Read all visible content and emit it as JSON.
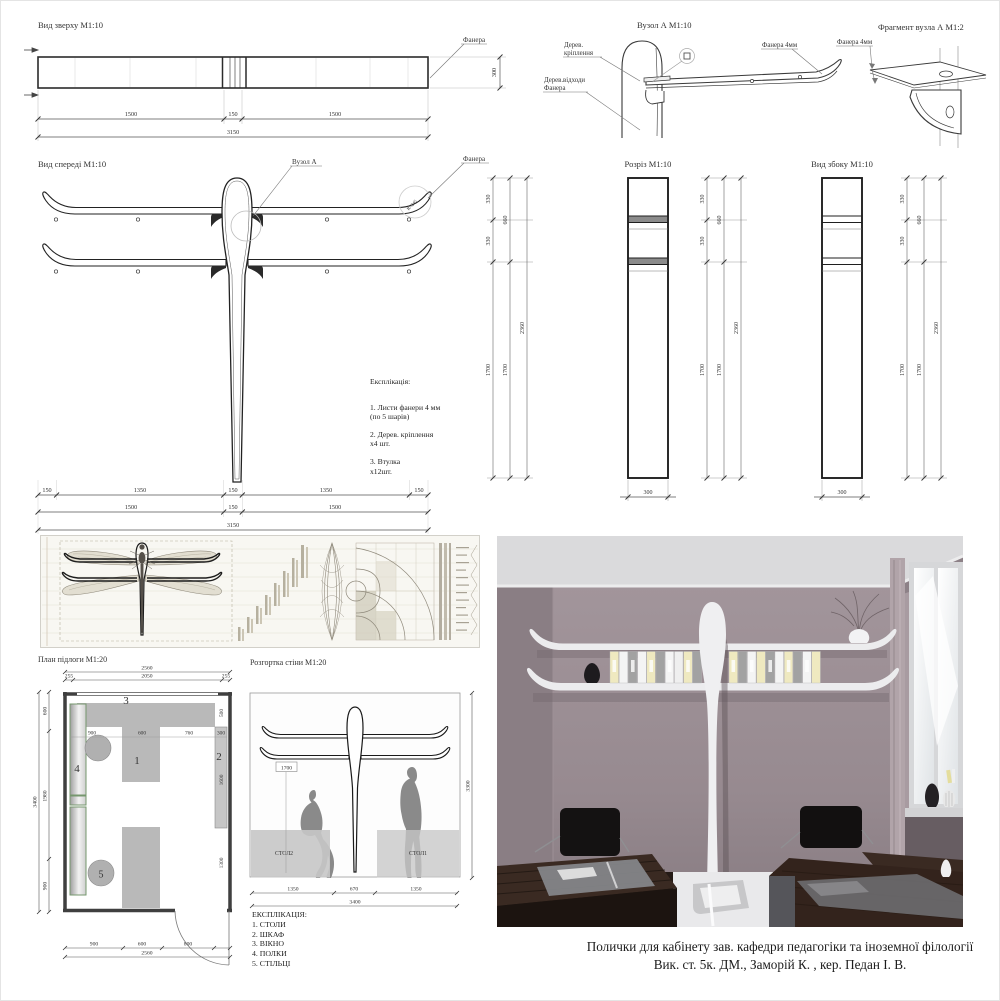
{
  "top_view": {
    "title": "Вид зверху М1:10",
    "plywood_label": "Фанера",
    "row1": [
      "1500",
      "150",
      "1500"
    ],
    "total": "3150",
    "depth": "300"
  },
  "node_a": {
    "title": "Вузол А М1:10",
    "wood_mount_l1": "Дерев.",
    "wood_mount_l2": "кріплення",
    "wood_waste_l1": "Дерев.відходи",
    "wood_waste_l2": "Фанера",
    "plywood_label": "Фанера 4мм"
  },
  "fragment_a": {
    "title": "Фрагмент вузла А М1:2",
    "plywood_label": "Фанера 4мм"
  },
  "front_view": {
    "title": "Вид спереді М1:10",
    "node_label": "Вузол А",
    "plywood_label": "Фанера",
    "radius": "R=245",
    "row1": [
      "150",
      "1350",
      "150",
      "1350",
      "150"
    ],
    "row2": [
      "1500",
      "150",
      "1500"
    ],
    "total": "3150"
  },
  "parts_list": {
    "title": "Експлікація:",
    "items": [
      {
        "l1": "1. Листи фанери 4 мм",
        "l2": "(по 5 шарів)"
      },
      {
        "l1": "2. Дерев. кріплення",
        "l2": "х4 шт."
      },
      {
        "l1": "3. Втулка",
        "l2": "х12шт."
      }
    ]
  },
  "section_view": {
    "title": "Розріз М1:10"
  },
  "side_view": {
    "title": "Вид збоку М1:10"
  },
  "vertical_dims": {
    "a": "330",
    "b": "660",
    "c": "330",
    "total": "2360",
    "lower": "1700",
    "width": "300"
  },
  "floor_plan": {
    "title": "План підлоги М1:20",
    "top_total": "2560",
    "top_left": "255",
    "top_mid": "2050",
    "top_right": "255",
    "left_total": "3400",
    "left_a": "600",
    "left_b": "1980",
    "left_c": "900",
    "inner_a": "900",
    "inner_b": "600",
    "inner_c": "760",
    "inner_d": "300",
    "right_a": "500",
    "right_b": "1600",
    "right_c": "1300",
    "bottom_a": "900",
    "bottom_b": "600",
    "bottom_c": "800",
    "bottom_total": "2560",
    "num1": "1",
    "num2": "2",
    "num3": "3",
    "num4": "4",
    "num5": "5"
  },
  "wall_elevation": {
    "title": "Розгортка стіни М1:20",
    "height_label": "1700",
    "table1": "СТОЛ1",
    "table2": "СТОЛ2",
    "dim_left": "1350",
    "dim_mid": "670",
    "dim_right": "1350",
    "dim_total": "3400",
    "dim_height": "3300"
  },
  "room_legend": {
    "title": "ЕКСПЛІКАЦІЯ:",
    "items": [
      "1. СТОЛИ",
      "2. ШКАФ",
      "3. ВІКНО",
      "4. ПОЛКИ",
      "5. СТІЛЬЦІ"
    ]
  },
  "caption": {
    "line1": "Полички для кабінету зав. кафедри педагогіки та іноземної філології",
    "line2": "Вик. ст. 5к. ДМ., Заморій К. , кер. Педан І. В."
  },
  "colors": {
    "line": "#2b2b2b",
    "dim": "#555555",
    "furniture_gray": "#b9b9b9",
    "cabinet_green": "#76976e",
    "wall_mauve": "#9a8c92",
    "wood_dark": "#2c1f1a",
    "binder_yellow": "#efe9c0",
    "shelf_white": "#ededef"
  }
}
